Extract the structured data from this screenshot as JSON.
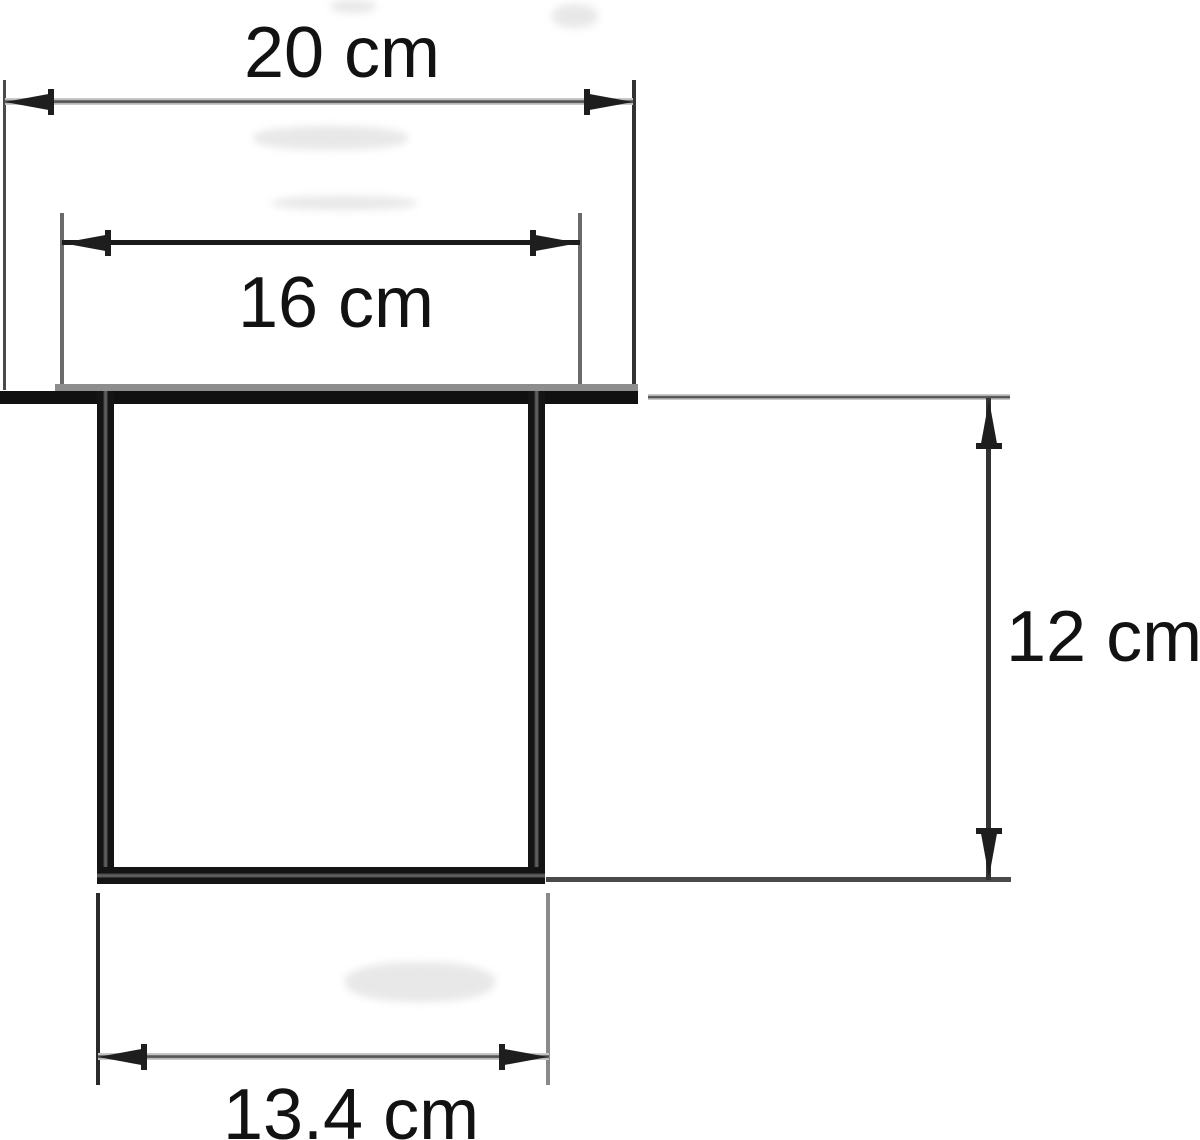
{
  "diagram": {
    "type": "technical-dimension-drawing",
    "shape": "open-top rectangular channel with top flange",
    "unit": "cm",
    "dimensions": {
      "top_outer": {
        "label": "20 cm",
        "value": 20,
        "orientation": "horizontal",
        "position": "top"
      },
      "top_inner": {
        "label": "16 cm",
        "value": 16,
        "orientation": "horizontal",
        "position": "upper"
      },
      "depth": {
        "label": "12 cm",
        "value": 12,
        "orientation": "vertical",
        "position": "right"
      },
      "bottom_inner": {
        "label": "13.4 cm",
        "value": 13.4,
        "orientation": "horizontal",
        "position": "bottom"
      }
    },
    "colors": {
      "background": "#ffffff",
      "ink": "#141414",
      "gray_line": "#565656",
      "light_gray": "#c9c9c9"
    }
  }
}
